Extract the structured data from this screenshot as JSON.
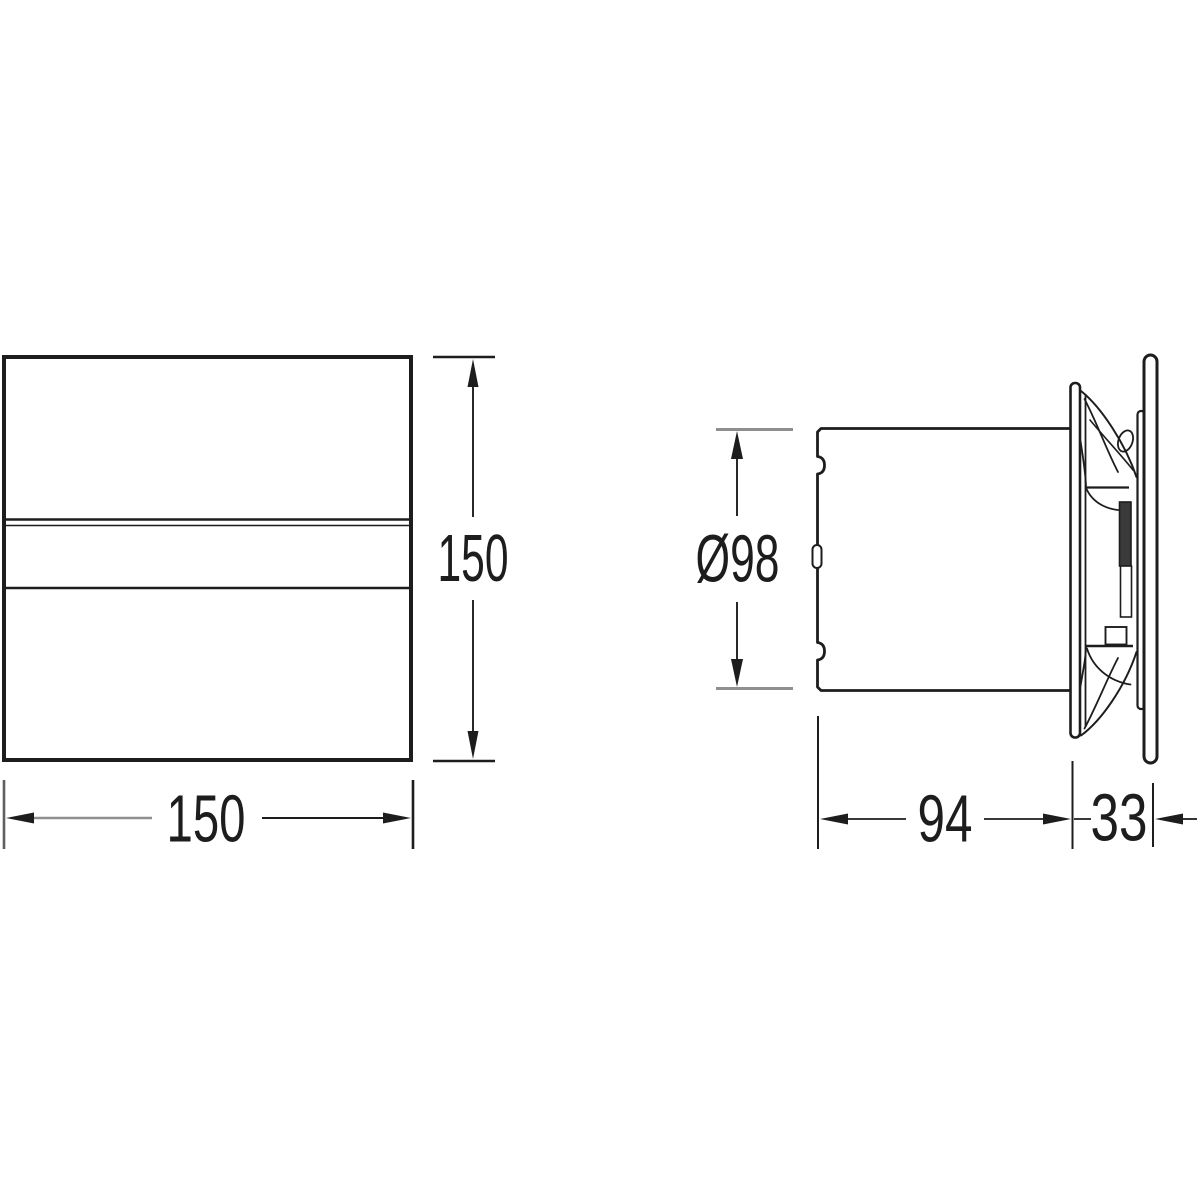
{
  "drawing": {
    "type": "technical-dimension-drawing",
    "subject": "extractor-fan-two-view-drawing",
    "background_color": "#ffffff",
    "line_color": "#1d1d1d",
    "extension_line_color": "#8f8f8f",
    "hub_fill_color": "#3a3a3a",
    "front_view": {
      "height_dimension": "150",
      "width_dimension": "150"
    },
    "side_view": {
      "diameter_dimension": "Ø98",
      "depth_dimension": "94",
      "front_thickness_dimension": "33"
    }
  }
}
